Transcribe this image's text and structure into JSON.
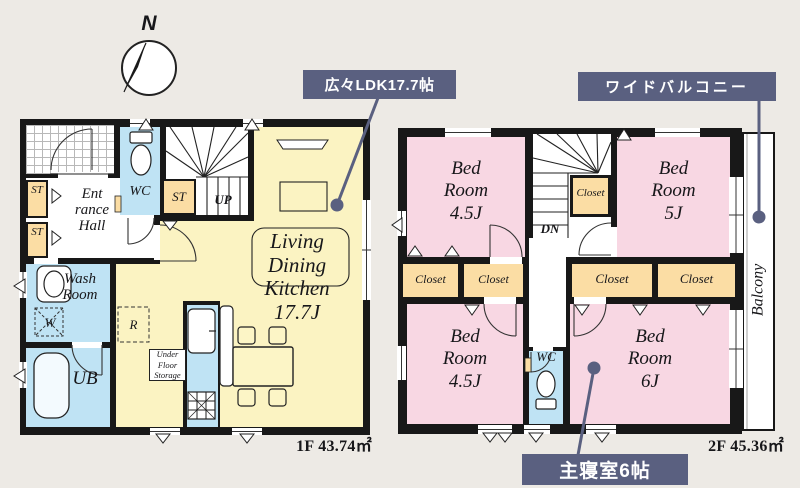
{
  "colors": {
    "background": "#edeae5",
    "wall": "#181818",
    "accent": "#5a6080",
    "ldk_floor": "#fbf3c2",
    "bedroom_floor": "#f8d7e3",
    "closet_floor": "#fbdda4",
    "wet_area_floor": "#bfe3f4"
  },
  "compass": {
    "n": "N"
  },
  "callouts": {
    "ldk": "広々LDK17.7帖",
    "balcony": "ワイドバルコニー",
    "master": "主寝室6帖"
  },
  "f1": {
    "area": "1F 43.74㎡",
    "ldk": {
      "l1": "Living",
      "l2": "Dining",
      "l3": "Kitchen",
      "l4": "17.7J"
    },
    "entrance": {
      "l1": "Ent",
      "l2": "rance",
      "l3": "Hall"
    },
    "wash": {
      "l1": "Wash",
      "l2": "Room"
    },
    "ub": "UB",
    "wc": "WC",
    "st": "ST",
    "up": "UP",
    "w": "W",
    "r": "R",
    "ufs": {
      "l1": "Under",
      "l2": "Floor",
      "l3": "Storage"
    }
  },
  "f2": {
    "area": "2F 45.36㎡",
    "bed45": {
      "l1": "Bed",
      "l2": "Room",
      "l3": "4.5J"
    },
    "bed5": {
      "l1": "Bed",
      "l2": "Room",
      "l3": "5J"
    },
    "bed6": {
      "l1": "Bed",
      "l2": "Room",
      "l3": "6J"
    },
    "closet": "Closet",
    "wc": "WC",
    "dn": "DN",
    "balcony": "Balcony"
  }
}
